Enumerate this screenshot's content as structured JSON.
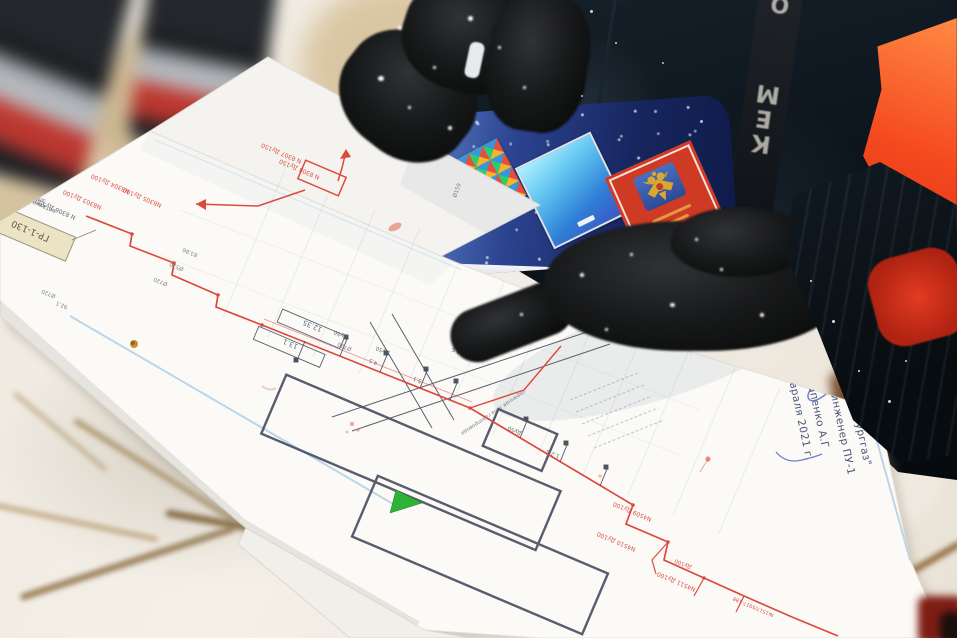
{
  "approval_stamp": {
    "lines": [
      "УТВЕРЖДАЮ :",
      "АО \"Екатеринбурггаз\"",
      "Главный инженер ПУ-1",
      "Потапенко А.Г",
      "25 февраля 2021 г."
    ]
  },
  "strap": {
    "letters": [
      "О",
      "М",
      "Е",
      "К"
    ]
  },
  "map": {
    "labels": [
      "ГР-1-130",
      "электроизолирующая",
      "вставка",
      "N 8306 Ду500",
      "N8304 Ду100",
      "N8303 Ду100",
      "N8305 Ду100",
      "83.86",
      "Ø520",
      "Ø720",
      "N 8307 Ду150",
      "N 8308 Ду150",
      "Ø159",
      "12.35",
      "13.1",
      "Ø720",
      "Ду50",
      "Ду50",
      "4.5",
      "5.1",
      "12 Б",
      "охранная зона газопровода",
      "Ду50",
      "1.2 Б",
      "Ø720",
      "92.1",
      "N4509 Ду100",
      "N4510 Ду100",
      "N4511 Ду100",
      "№1517/5917-188",
      "Ду100"
    ]
  },
  "booklet": {
    "cards": [
      "mosaic-pattern-card",
      "blue-gradient-card",
      "red-emblem-card"
    ]
  },
  "colors": {
    "hi_vis_orange": "#f5481f",
    "pipeline_red": "#dd4a3c",
    "booklet_blue": "#24357d",
    "marker_green": "#2fb339",
    "stamp_ink": "#4a5578",
    "signature_blue": "#5570c0"
  }
}
